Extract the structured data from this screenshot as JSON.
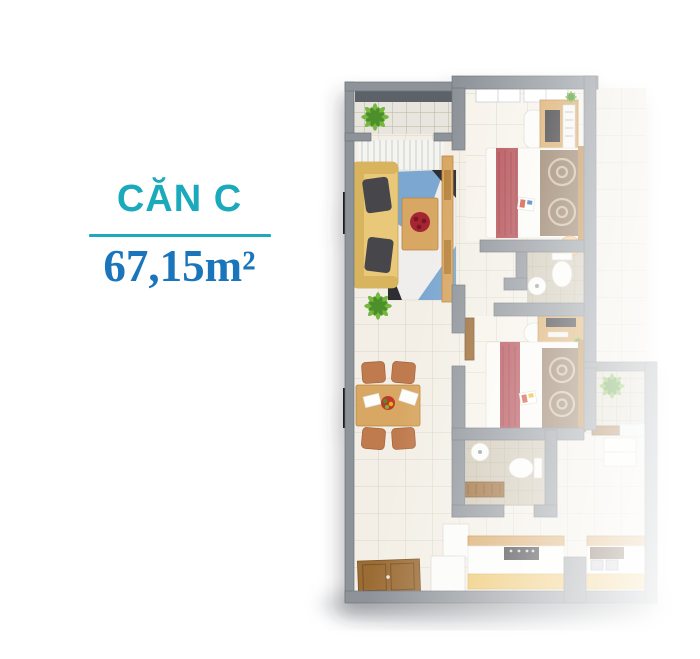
{
  "header": {
    "title": "CĂN C",
    "area": "67,15m²"
  },
  "colors": {
    "teal": "#1aaabc",
    "blue": "#1b75bb",
    "wall": "#8d9399",
    "wall-dark": "#70767c",
    "rail": "#5d6267",
    "floor": "#f3efe6",
    "floor-light": "#f7f3eb",
    "floor-line": "#dbd5c7",
    "bath-floor": "#d0c8b5",
    "bath-line": "#bdb4a0",
    "balcony-floor": "#e7e5dd",
    "balcony2-floor": "#dedac9",
    "wood": "#d8a763",
    "wood-dark": "#b9853f",
    "door-wood": "#9c6c35",
    "sofa": "#e9c979",
    "pillow": "#47474c",
    "rug-blue": "#7ba7d0",
    "rug-white": "#efeeec",
    "rug-dark": "#2e2e33",
    "bed-white": "#fbfaf6",
    "runner-red": "#b2474e",
    "blanket": "#8d7258",
    "blanket-light": "#cbb89a",
    "plant": "#74b83e",
    "plant-dark": "#4e8f2a",
    "counter-gold": "#edc468",
    "appliance-dark": "#2b2b2e",
    "chair": "#bf7a4e",
    "flower-red": "#a52830"
  }
}
